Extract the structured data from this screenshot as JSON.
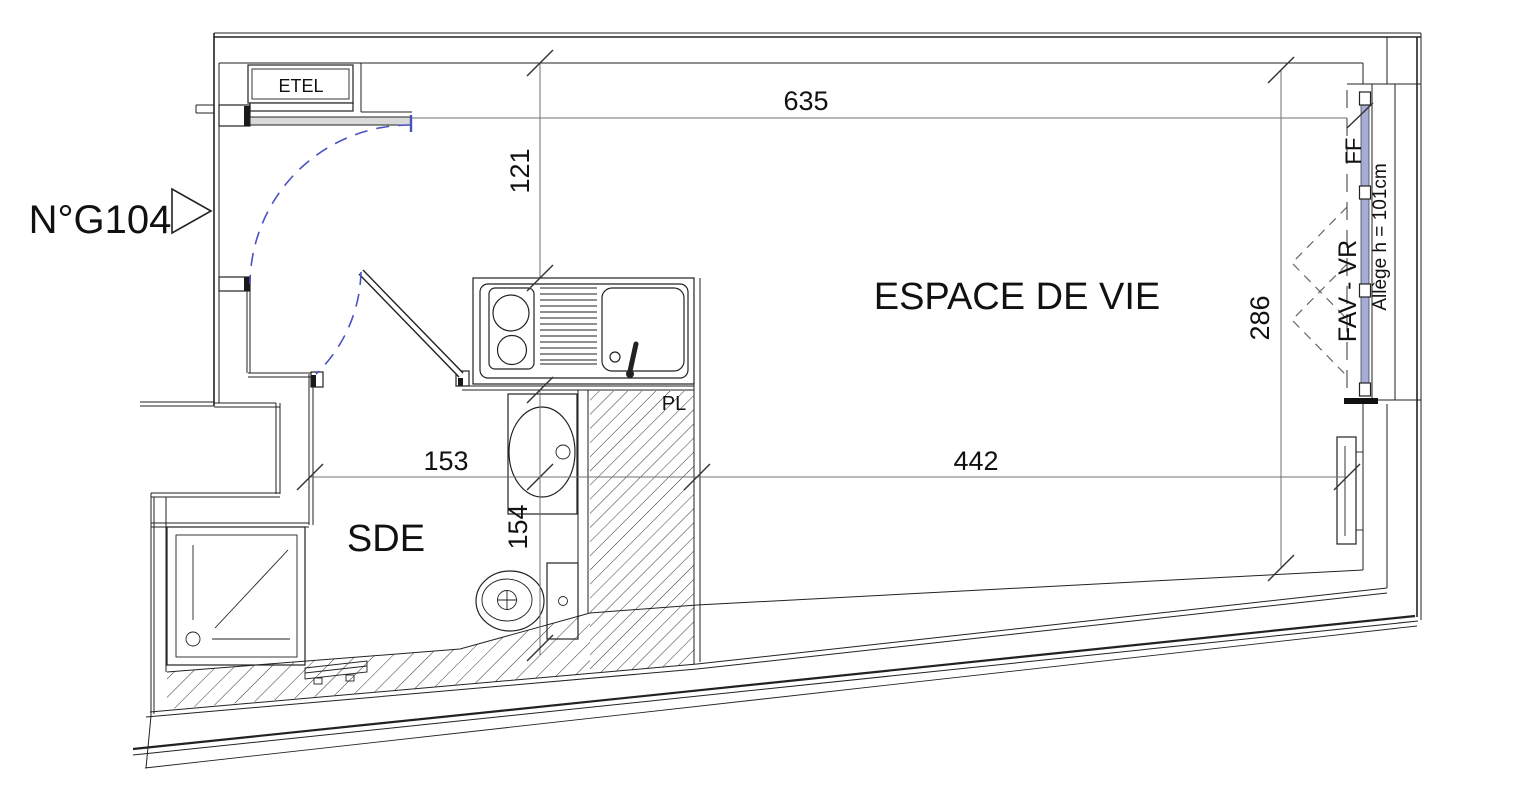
{
  "unit": {
    "number": "N°G104"
  },
  "rooms": {
    "living": "ESPACE DE VIE",
    "shower_room": "SDE",
    "closet": "PL",
    "utility": "ETEL"
  },
  "window": {
    "fixed_label": "FF",
    "casement_label": "FAV - VR",
    "sill_label": "Allège h = 101cm"
  },
  "dimensions": {
    "top_width": "635",
    "entry_depth": "121",
    "window_wall": "286",
    "sde_width": "153",
    "living_width": "442",
    "sde_length": "154"
  },
  "colors": {
    "line": "#222222",
    "dim_line": "#707070",
    "door_swing": "#4a52c0",
    "glazing": "#a6acd8"
  }
}
